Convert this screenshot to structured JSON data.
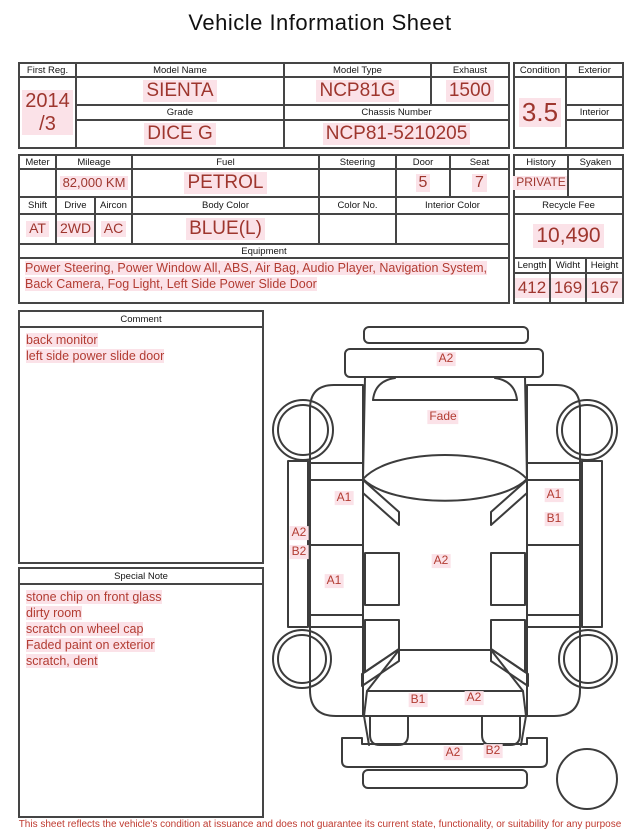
{
  "title": "Vehicle Information Sheet",
  "colors": {
    "value_red": "#9e362e",
    "label_red": "#b23c32",
    "highlight_pink": "#fbe2e8",
    "line_dark": "#454545",
    "footer_red": "#bf3a30"
  },
  "table1": {
    "first_reg": {
      "label": "First Reg.",
      "value": "2014\n/3"
    },
    "model_name": {
      "label": "Model Name",
      "value": "SIENTA"
    },
    "model_type": {
      "label": "Model Type",
      "value": "NCP81G"
    },
    "exhaust": {
      "label": "Exhaust",
      "value": "1500"
    },
    "grade": {
      "label": "Grade",
      "value": "DICE G"
    },
    "chassis_number": {
      "label": "Chassis Number",
      "value": "NCP81-5210205"
    }
  },
  "condition_box": {
    "condition": {
      "label": "Condition",
      "value": "3.5"
    },
    "exterior": {
      "label": "Exterior",
      "value": ""
    },
    "interior": {
      "label": "Interior",
      "value": ""
    }
  },
  "table2": {
    "meter": {
      "label": "Meter",
      "value": ""
    },
    "mileage": {
      "label": "Mileage",
      "value": "82,000 KM"
    },
    "fuel": {
      "label": "Fuel",
      "value": "PETROL"
    },
    "steering": {
      "label": "Steering",
      "value": ""
    },
    "door": {
      "label": "Door",
      "value": "5"
    },
    "seat": {
      "label": "Seat",
      "value": "7"
    },
    "shift": {
      "label": "Shift",
      "value": "AT"
    },
    "drive": {
      "label": "Drive",
      "value": "2WD"
    },
    "aircon": {
      "label": "Aircon",
      "value": "AC"
    },
    "body_color": {
      "label": "Body Color",
      "value": "BLUE(L)"
    },
    "color_no": {
      "label": "Color No.",
      "value": ""
    },
    "interior_color": {
      "label": "Interior Color",
      "value": ""
    },
    "equipment": {
      "label": "Equipment",
      "value": "Power Steering, Power Window  All, ABS, Air Bag, Audio Player, Navigation System, Back Camera, Fog Light, Left Side Power Slide Door"
    }
  },
  "history_box": {
    "history": {
      "label": "History",
      "value": "PRIVATE"
    },
    "syaken": {
      "label": "Syaken",
      "value": ""
    },
    "recycle_fee": {
      "label": "Recycle Fee",
      "value": "10,490"
    },
    "length": {
      "label": "Length",
      "value": "412"
    },
    "width": {
      "label": "Widht",
      "value": "169"
    },
    "height": {
      "label": "Height",
      "value": "167"
    }
  },
  "comment": {
    "label": "Comment",
    "lines": [
      "back monitor",
      "left side power slide door"
    ]
  },
  "special_note": {
    "label": "Special Note",
    "lines": [
      "stone chip on front glass",
      "dirty room",
      "scratch on wheel cap",
      "Faded paint on exterior",
      "scratch, dent"
    ]
  },
  "diagram": {
    "labels": [
      {
        "text": "A2",
        "area": "front-bumper"
      },
      {
        "text": "Fade",
        "area": "hood"
      },
      {
        "text": "A1",
        "area": "left-front-door"
      },
      {
        "text": "A1",
        "area": "right-front-door"
      },
      {
        "text": "B1",
        "area": "right-front-door"
      },
      {
        "text": "A2",
        "area": "left-sill"
      },
      {
        "text": "B2",
        "area": "left-sill"
      },
      {
        "text": "A1",
        "area": "left-rear-door"
      },
      {
        "text": "A2",
        "area": "roof"
      },
      {
        "text": "B1",
        "area": "tailgate"
      },
      {
        "text": "A2",
        "area": "tailgate"
      },
      {
        "text": "A2",
        "area": "rear-bumper"
      },
      {
        "text": "B2",
        "area": "rear-bumper"
      }
    ]
  },
  "footer": "This sheet reflects the vehicle's condition at issuance and does not guarantee its current state, functionality, or suitability for any purpose"
}
